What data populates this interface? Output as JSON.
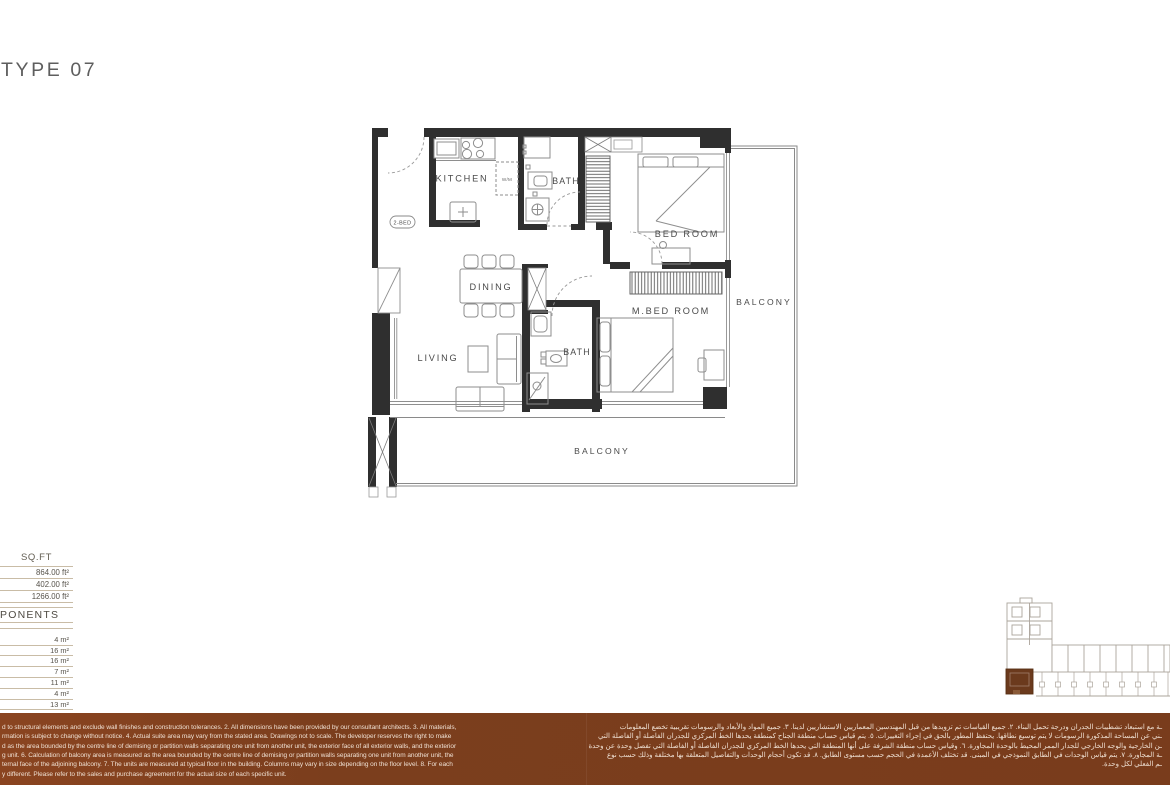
{
  "page": {
    "title": "TYPE 07"
  },
  "floor_plan": {
    "unit_tag": "2-BED",
    "labels": {
      "kitchen": "KITCHEN",
      "bath_top": "BATH",
      "bedroom": "BED ROOM",
      "dining": "DINING",
      "living": "LIVING",
      "master_bedroom": "M.BED ROOM",
      "bath_master": "BATH",
      "balcony_side": "BALCONY",
      "balcony_bottom": "BALCONY",
      "washer": "W/M"
    }
  },
  "area_table": {
    "sqft_header": "SQ.FT",
    "sqft_values": [
      "864.00 ft²",
      "402.00 ft²",
      "1266.00 ft²"
    ],
    "components_header_visible": "PONENTS",
    "component_values": [
      "4 m²",
      "16 m²",
      "16 m²",
      "7 m²",
      "11 m²",
      "4 m²",
      "13 m²"
    ]
  },
  "disclaimer": {
    "english_lines": [
      "d to structural elements and exclude wall finishes and construction tolerances. 2. All dimensions have been provided by our consultant architects. 3. All materials,",
      "rmation is subject to change without notice. 4. Actual suite area may vary from the stated area. Drawings not to scale. The developer reserves the right to make",
      "d as the area bounded by the centre line of demising or partition walls separating one unit from another unit, the exterior face of all exterior walls, and the exterior",
      "g unit. 6. Calculation of balcony area is measured as the area bounded by the centre line of demising or partition walls separating one unit from another unit, the",
      "ternal face of the adjoining balcony. 7. The units are measured at typical floor in the building. Columns may vary in size depending on the floor level. 8. For each",
      "y different. Please refer to the sales and purchase agreement for the actual size of each specific unit."
    ],
    "arabic_lines": [
      "ـة مع استبعاد تشطيبات الجدران ودرجة تحمل البناء. ٢. جميع القياسات تم تزويدها من قبل المهندسين المعماريين الاستشاريين لدينا. ٣. جميع المواد والأبعاد والرسومات تقريبية تخضع المعلومات",
      "ـني عن المساحة المذكورة الرسومات لا يتم توسيع نطاقها. يحتفظ المطور بالحق في إجراء التغييرات. ٥. يتم قياس حساب منطقة الجناح كمنطقة يحدها الخط المركزي للجدران الفاصلة أو الفاصلة التي",
      "ـن الخارجية والوجه الخارجي للجدار الممر المحيط بالوحدة المجاورة. ٦. وقياس حساب منطقة الشرفة على أنها المنطقة التي يحدها الخط المركزي للجدران الفاصلة أو الفاصلة التي تفصل وحدة عن وحدة",
      "ـة المجاورة. ٧. يتم قياس الوحدات في الطابق النموذجي في المبنى. قد تختلف الأعمدة في الحجم حسب مستوى الطابق. ٨. قد تكون أحجام الوحدات والتفاصيل المتعلقة بها مختلفة وذلك حسب نوع",
      "ـم الفعلي لكل وحدة."
    ]
  },
  "key_plan": {
    "highlight_color": "#6b3a1d"
  },
  "colors": {
    "band_background": "#7b3e1d",
    "table_line": "#c9bca6",
    "plan_wall": "#2f2f2f",
    "keyplan_outline": "#aba49b"
  }
}
